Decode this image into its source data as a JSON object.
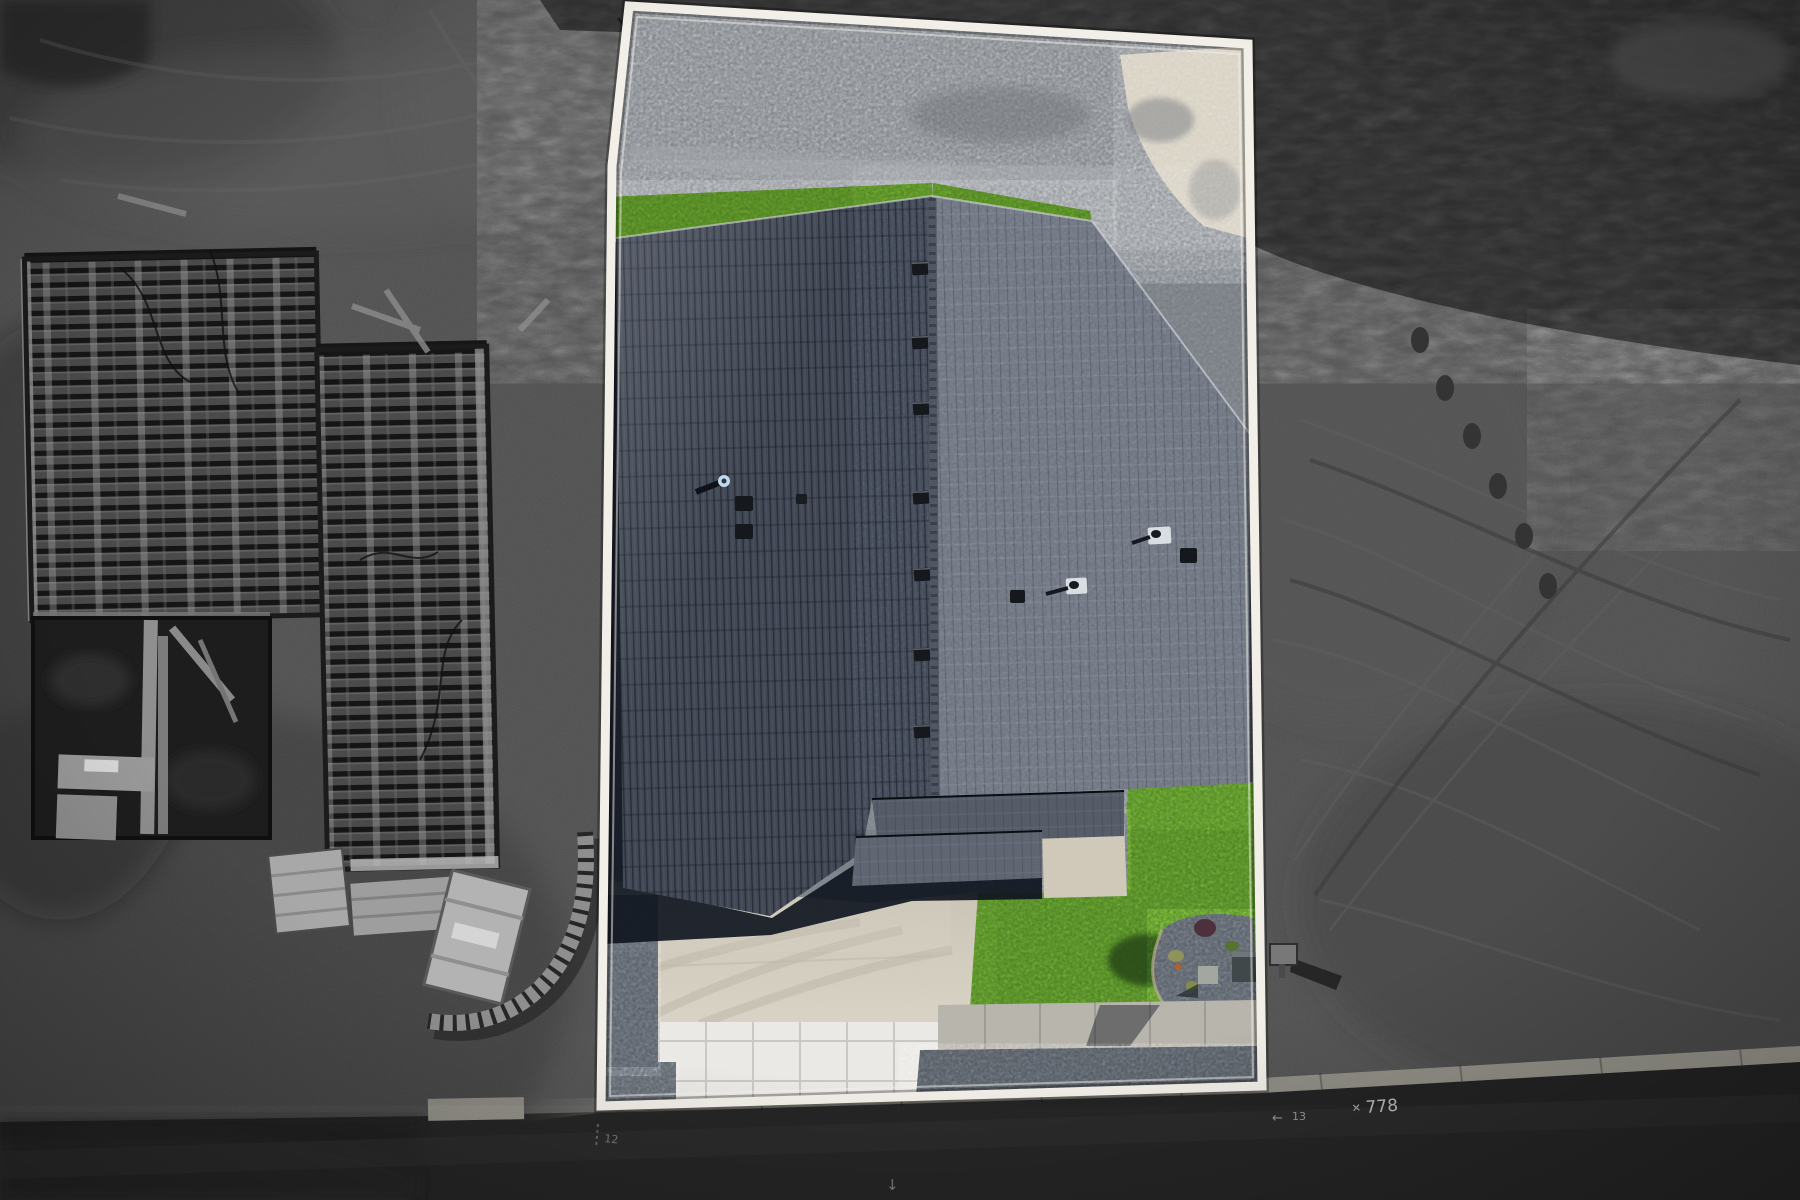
{
  "image": {
    "description": "Aerial drone photograph of a newly built house on a lot outlined with a white property boundary; the lot interior is in full colour while the surrounding terrain (sand, construction framing, road, scrub) is desaturated grey.",
    "style": "real-estate aerial lot highlight"
  },
  "colors": {
    "boundary": "#f2efe8",
    "boundary_inner": "rgba(245,242,235,0.5)",
    "sand": "#4f4f4f",
    "sand_dark": "#3a3a3a",
    "vegetation": "#2d2d2d",
    "road": "#232323",
    "gutter": "#8f8d84",
    "gravel_yard": "#7d8187",
    "sand_patch": "#d7d0c1",
    "grass_strip": "#48741f",
    "lawn": "#4d7c24",
    "lawn_shadow": "#274512",
    "roof_left": "#3d434f",
    "roof_right": "#6a707b",
    "ridge": "#4e5460",
    "porch_tier1": "#535a66",
    "porch_tier2": "#5d6470",
    "walkway": "#cfc8b8",
    "driveway": "#d0cabb",
    "pavers": "#ebe9e5",
    "sidewalk": "#b6b3aa",
    "gravel_strip": "#565c64",
    "house_shadow": "#0e141d",
    "framing_base": "#4a4a4a",
    "framing_dark": "#161616",
    "pit": "#1d1d1d",
    "lumber": "#ababab",
    "curb_wall": "#8e8e8e",
    "vent": "#14171c",
    "vent_flashing": "#d8dde3",
    "pipe_cap": "#bdd7ee",
    "utility_box_dark": "#3f4648",
    "utility_box_light": "#9fa69d",
    "mailbox": "#787878"
  },
  "road_markings": {
    "lot_number": "778",
    "cross": "✕",
    "mark_left": "13",
    "arrow_left": "←",
    "mark_small": "12",
    "arrow_down": "↓"
  }
}
